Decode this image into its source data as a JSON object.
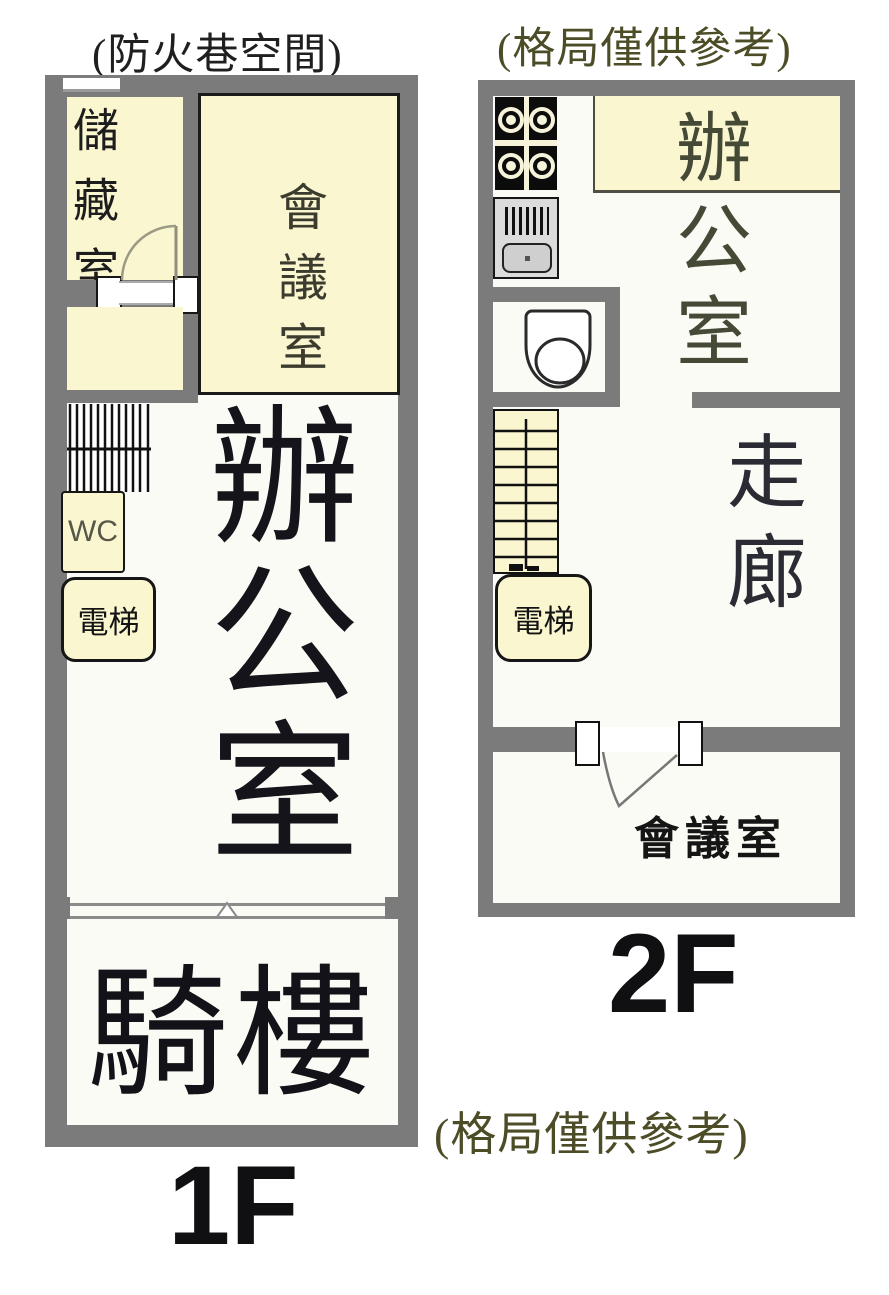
{
  "notes": {
    "floor1_top": "(防火巷空間)",
    "floor2_top": "(格局僅供參考)",
    "bottom": "(格局僅供參考)"
  },
  "floor1": {
    "label": "1F",
    "rooms": {
      "storage": "儲藏室",
      "meeting": "會議室",
      "office": "辦公室",
      "wc": "WC",
      "elevator": "電梯",
      "arcade": "騎樓"
    }
  },
  "floor2": {
    "label": "2F",
    "rooms": {
      "office": "辦公室",
      "corridor": "走廊",
      "elevator": "電梯",
      "meeting": "會議室"
    }
  },
  "icons": {
    "stove": "stove-icon",
    "sink": "sink-icon",
    "toilet": "toilet-icon",
    "stairs": "stairs-icon",
    "door": "door-swing-icon",
    "entry_triangle": "entry-marker-icon"
  },
  "colors": {
    "wall_gray": "#7b7b7b",
    "room_cream": "#faf6d0",
    "room_white": "#fbfbf5",
    "note_olive": "#4c4c26",
    "text_black": "#17171d"
  }
}
